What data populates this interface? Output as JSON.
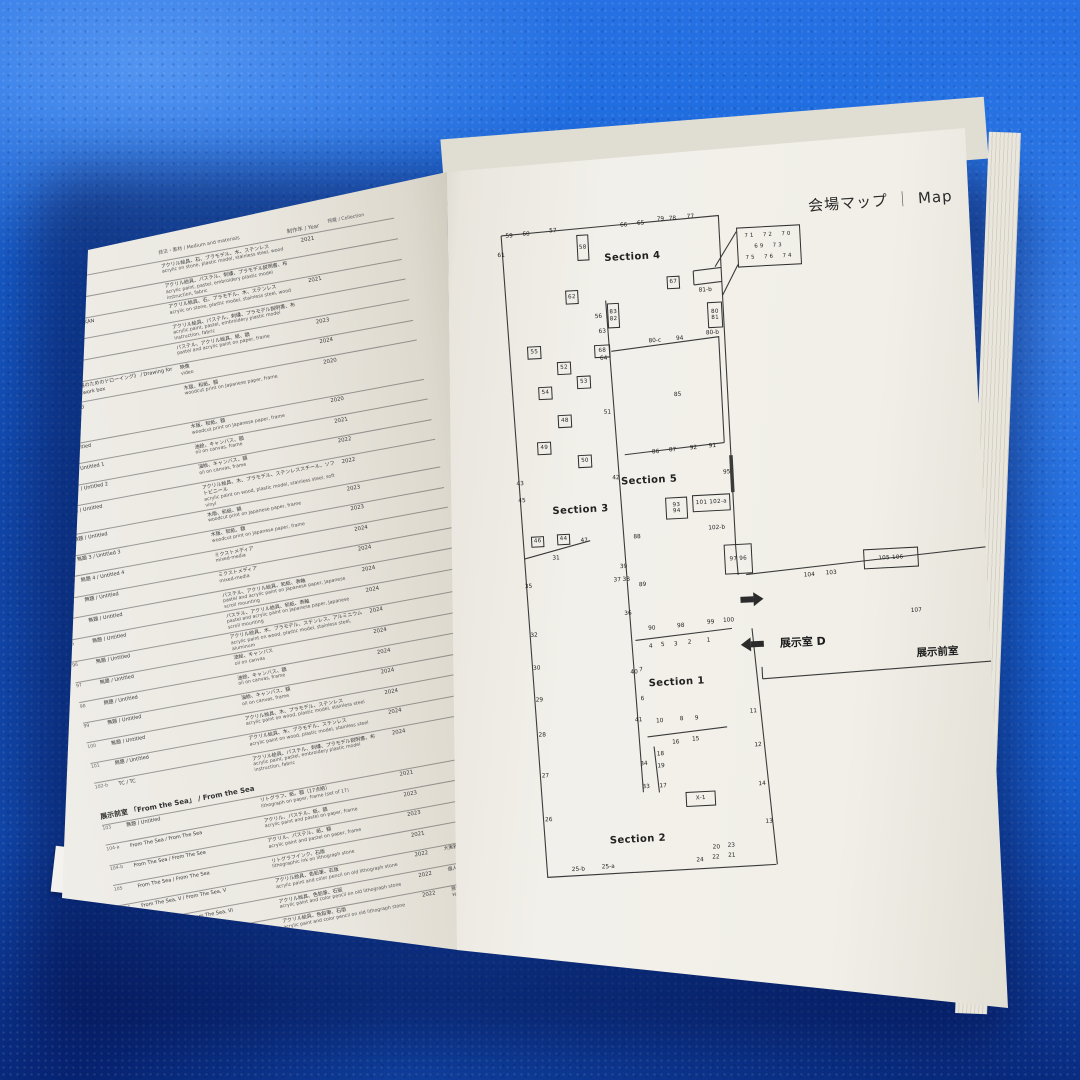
{
  "header": {
    "title_jp": "会場マップ",
    "title_en": "Map"
  },
  "left_page": {
    "column_headers": {
      "medium": "技法・素材 / Medium and materials",
      "year": "制作年 / Year",
      "collection": "所蔵 / Collection"
    },
    "page_number": "4",
    "sections": [
      {
        "heading": "",
        "rows": [
          [
            "80",
            "NJA / TRA",
            "アクリル絵具、石、プラモデル、木、ステンレス",
            "acrylic on stone, plastic model, stainless steel, wood",
            "2021",
            ""
          ],
          [
            "81-a",
            "",
            "アクリル絵具、パステル、刺繍、プラモデル説明書、布",
            "acrylic paint, pastel, embroidery plastic model instruction, fabric",
            "",
            ""
          ],
          [
            "81-b",
            "BACHAKAN / BACHAKAN",
            "アクリル絵具、石、プラモデル、木、ステンレス",
            "acrylic on stone, plastic model, stainless steel, wood",
            "2021",
            ""
          ],
          [
            "82-a",
            "",
            "アクリル絵具、パステル、刺繍、プラモデル説明書、布",
            "acrylic paint, pastel, embroidery plastic model instruction, fabric",
            "",
            ""
          ],
          [
            "82-b",
            "TC / TC",
            "パステル、アクリル絵具、紙、額",
            "pastel and acrylic paint on paper, frame",
            "2023",
            ""
          ],
          [
            "83",
            "《KP91-1 花｜霧のためのドローイング》 / Drawing for the KP91-1 artwork box",
            "映像",
            "video",
            "2024",
            ""
          ],
          [
            "84",
            "無題 / Untitled",
            "木版、和紙、額",
            "woodcut print on Japanese paper, frame",
            "2020",
            ""
          ]
        ]
      },
      {
        "heading": "Chapter 5",
        "rows": [
          [
            "85",
            "無題 / Untitled",
            "木版、和紙、額",
            "woodcut print on Japanese paper, frame",
            "2020",
            ""
          ],
          [
            "86",
            "無題 1 / Untitled 1",
            "油絵、キャンバス、額",
            "oil on canvas, frame",
            "2021",
            ""
          ],
          [
            "87",
            "無題 2 / Untitled 2",
            "油絵、キャンバス、額",
            "oil on canvas, frame",
            "2022",
            ""
          ],
          [
            "88",
            "無題 / Untitled",
            "アクリル絵具、木、プラモデル、ステンレススチール、ソフトビニール",
            "acrylic paint on wood, plastic model, stainless steel, soft vinyl",
            "2022",
            ""
          ],
          [
            "89",
            "無題 / Untitled",
            "木版、和紙、額",
            "woodcut print on Japanese paper, frame",
            "2023",
            ""
          ],
          [
            "91",
            "無題 3 / Untitled 3",
            "木版、和紙、額",
            "woodcut print on Japanese paper, frame",
            "2023",
            ""
          ],
          [
            "92",
            "無題 4 / Untitled 4",
            "ミクストメディア",
            "mixed-media",
            "2024",
            ""
          ],
          [
            "93",
            "無題 / Untitled",
            "ミクストメディア",
            "mixed-media",
            "2024",
            ""
          ],
          [
            "94",
            "無題 / Untitled",
            "パステル、アクリル絵具、和紙、表軸",
            "pastel and acrylic paint on Japanese paper, Japanese scroll mounting",
            "2024",
            ""
          ],
          [
            "95",
            "無題 / Untitled",
            "パステル、アクリル絵具、和紙、表軸",
            "pastel and acrylic paint on Japanese paper, Japanese scroll mounting",
            "2024",
            ""
          ],
          [
            "96",
            "無題 / Untitled",
            "アクリル絵具、木、プラモデル、ステンレス、アルミニウム",
            "acrylic paint on wood, plastic model, stainless steel, aluminum",
            "2024",
            ""
          ],
          [
            "97",
            "無題 / Untitled",
            "油絵、キャンバス",
            "oil on canvas",
            "2024",
            ""
          ],
          [
            "98",
            "無題 / Untitled",
            "油絵、キャンバス、額",
            "oil on canvas, frame",
            "2024",
            ""
          ],
          [
            "99",
            "無題 / Untitled",
            "油絵、キャンバス、額",
            "oil on canvas, frame",
            "2024",
            ""
          ],
          [
            "100",
            "無題 / Untitled",
            "アクリル絵具、木、プラモデル、ステンレス",
            "acrylic paint on wood, plastic model, stainless steel",
            "2024",
            ""
          ],
          [
            "101",
            "無題 / Untitled",
            "アクリル絵具、木、プラモデル、ステンレス",
            "acrylic paint on wood, plastic model, stainless steel",
            "2024",
            ""
          ],
          [
            "102-b",
            "TC / TC",
            "アクリル絵具、パステル、刺繍、プラモデル説明書、布",
            "acrylic paint, pastel, embroidery plastic model instruction, fabric",
            "2024",
            ""
          ]
        ]
      },
      {
        "heading": "展示前室 「From the Sea」 / From the Sea",
        "rows": [
          [
            "103",
            "無題 / Untitled",
            "リトグラフ、紙、額（17点組）",
            "lithograph on paper, frame (set of 17)",
            "2021",
            ""
          ],
          [
            "104-a",
            "From The Sea / From The Sea",
            "アクリル、パステル、紙、額",
            "acrylic paint and pastel on paper, frame",
            "2023",
            ""
          ],
          [
            "104-b",
            "From The Sea / From The Sea",
            "アクリル、パステル、紙、額",
            "acrylic paint and pastel on paper, frame",
            "2023",
            ""
          ],
          [
            "105",
            "From The Sea / From The Sea",
            "リトグラフインク、石版",
            "lithographic ink on lithograph stone",
            "2021",
            ""
          ],
          [
            "106-1",
            "From The Sea, V / From The Sea, V",
            "アクリル絵具、色鉛筆、石版",
            "acrylic paint and color pencil on old lithograph stone",
            "2022",
            "大実雅一"
          ],
          [
            "106-2",
            "From The Sea, VI / From The Sea, VI",
            "アクリル絵具、色鉛筆、石版",
            "acrylic paint and color pencil on old lithograph stone",
            "2022",
            "個人蔵 / private collection"
          ],
          [
            "106-3",
            "From The Sea, VII / From The Sea, VII",
            "アクリル絵具、色鉛筆、石版",
            "acrylic paint and color pencil on old lithograph stone",
            "2022",
            "原田マハコレクション / Harada Maha Collection"
          ]
        ]
      }
    ]
  },
  "map": {
    "labels": {
      "room_d": "展示室 D",
      "anteroom": "展示前室"
    },
    "annex_rows": [
      "71  72  70",
      "69  73",
      "75  76  74"
    ],
    "sections": [
      [
        "Section 4",
        150,
        50
      ],
      [
        "Section 3",
        85,
        300
      ],
      [
        "Section 5",
        155,
        274
      ],
      [
        "Section 1",
        172,
        477
      ],
      [
        "Section 2",
        125,
        632
      ]
    ],
    "plain": [
      [
        "59",
        28,
        23
      ],
      [
        "60",
        45,
        22
      ],
      [
        "57",
        72,
        20
      ],
      [
        "61",
        19,
        42
      ],
      [
        "66",
        143,
        18
      ],
      [
        "65",
        160,
        17
      ],
      [
        "79",
        180,
        14
      ],
      [
        "78",
        192,
        14
      ],
      [
        "77",
        210,
        13
      ],
      [
        "81-b",
        221,
        87
      ],
      [
        "80-b",
        226,
        130
      ],
      [
        "80-c",
        168,
        135
      ],
      [
        "94",
        193,
        134
      ],
      [
        "85",
        188,
        190
      ],
      [
        "56",
        113,
        108
      ],
      [
        "63",
        116,
        123
      ],
      [
        "64",
        116,
        150
      ],
      [
        "51",
        117,
        204
      ],
      [
        "42",
        122,
        270
      ],
      [
        "43",
        26,
        271
      ],
      [
        "45",
        27,
        288
      ],
      [
        "86",
        163,
        246
      ],
      [
        "87",
        180,
        245
      ],
      [
        "92",
        201,
        244
      ],
      [
        "91",
        220,
        243
      ],
      [
        "95",
        233,
        270
      ],
      [
        "88",
        140,
        330
      ],
      [
        "89",
        143,
        378
      ],
      [
        "102-b",
        220,
        325
      ],
      [
        "31",
        58,
        347
      ],
      [
        "47",
        87,
        331
      ],
      [
        "39",
        125,
        359
      ],
      [
        "37",
        118,
        372
      ],
      [
        "38",
        127,
        372
      ],
      [
        "36",
        127,
        406
      ],
      [
        "35",
        29,
        374
      ],
      [
        "32",
        32,
        423
      ],
      [
        "30",
        33,
        456
      ],
      [
        "29",
        34,
        488
      ],
      [
        "28",
        35,
        523
      ],
      [
        "27",
        36,
        564
      ],
      [
        "26",
        37,
        608
      ],
      [
        "40",
        130,
        465
      ],
      [
        "41",
        132,
        513
      ],
      [
        "34",
        135,
        557
      ],
      [
        "33",
        136,
        580
      ],
      [
        "90",
        150,
        422
      ],
      [
        "98",
        179,
        421
      ],
      [
        "99",
        209,
        419
      ],
      [
        "100",
        227,
        418
      ],
      [
        "4",
        148,
        440
      ],
      [
        "5",
        160,
        439
      ],
      [
        "3",
        173,
        439
      ],
      [
        "2",
        187,
        438
      ],
      [
        "1",
        206,
        437
      ],
      [
        "7",
        137,
        463
      ],
      [
        "6",
        137,
        492
      ],
      [
        "10",
        153,
        515
      ],
      [
        "8",
        175,
        514
      ],
      [
        "9",
        190,
        514
      ],
      [
        "16",
        168,
        537
      ],
      [
        "15",
        188,
        535
      ],
      [
        "18",
        152,
        548
      ],
      [
        "19",
        152,
        560
      ],
      [
        "17",
        153,
        580
      ],
      [
        "11",
        247,
        510
      ],
      [
        "12",
        250,
        544
      ],
      [
        "14",
        252,
        583
      ],
      [
        "13",
        257,
        621
      ],
      [
        "20",
        203,
        644
      ],
      [
        "23",
        218,
        643
      ],
      [
        "24",
        186,
        656
      ],
      [
        "22",
        202,
        654
      ],
      [
        "21",
        218,
        653
      ],
      [
        "25-b",
        64,
        659
      ],
      [
        "25-a",
        94,
        658
      ],
      [
        "104",
        310,
        377
      ],
      [
        "103",
        332,
        376
      ],
      [
        "107",
        415,
        418
      ]
    ],
    "boxed": [
      [
        "58",
        95,
        25,
        12,
        26
      ],
      [
        "62",
        81,
        80,
        13,
        14
      ],
      [
        "67",
        183,
        71,
        13,
        13
      ],
      [
        "55",
        40,
        134,
        14,
        13
      ],
      [
        "52",
        69,
        151,
        14,
        13
      ],
      [
        "53",
        88,
        166,
        14,
        13
      ],
      [
        "54",
        49,
        175,
        14,
        13
      ],
      [
        "48",
        67,
        204,
        14,
        13
      ],
      [
        "49",
        45,
        230,
        14,
        13
      ],
      [
        "50",
        85,
        245,
        14,
        13
      ],
      [
        "46",
        34,
        324,
        13,
        11
      ],
      [
        "44",
        60,
        323,
        13,
        11
      ],
      [
        "68",
        107,
        136,
        16,
        13
      ],
      [
        "X-1",
        175,
        587,
        30,
        15
      ],
      [
        "101 102-a",
        197,
        291,
        38,
        17
      ],
      [
        "105 106",
        365,
        354,
        55,
        20
      ],
      [
        "97 96",
        226,
        342,
        28,
        30
      ]
    ],
    "boxed2": [
      [
        "83|82",
        122,
        95,
        12,
        25
      ],
      [
        "80|81",
        222,
        99,
        15,
        26
      ],
      [
        "93|94",
        170,
        292,
        22,
        22
      ]
    ]
  },
  "colors": {
    "towel_blue": "#1b6be0",
    "page": "#f0eee8",
    "ink": "#2b2b2b",
    "wall_line": "#3b3b3b"
  }
}
